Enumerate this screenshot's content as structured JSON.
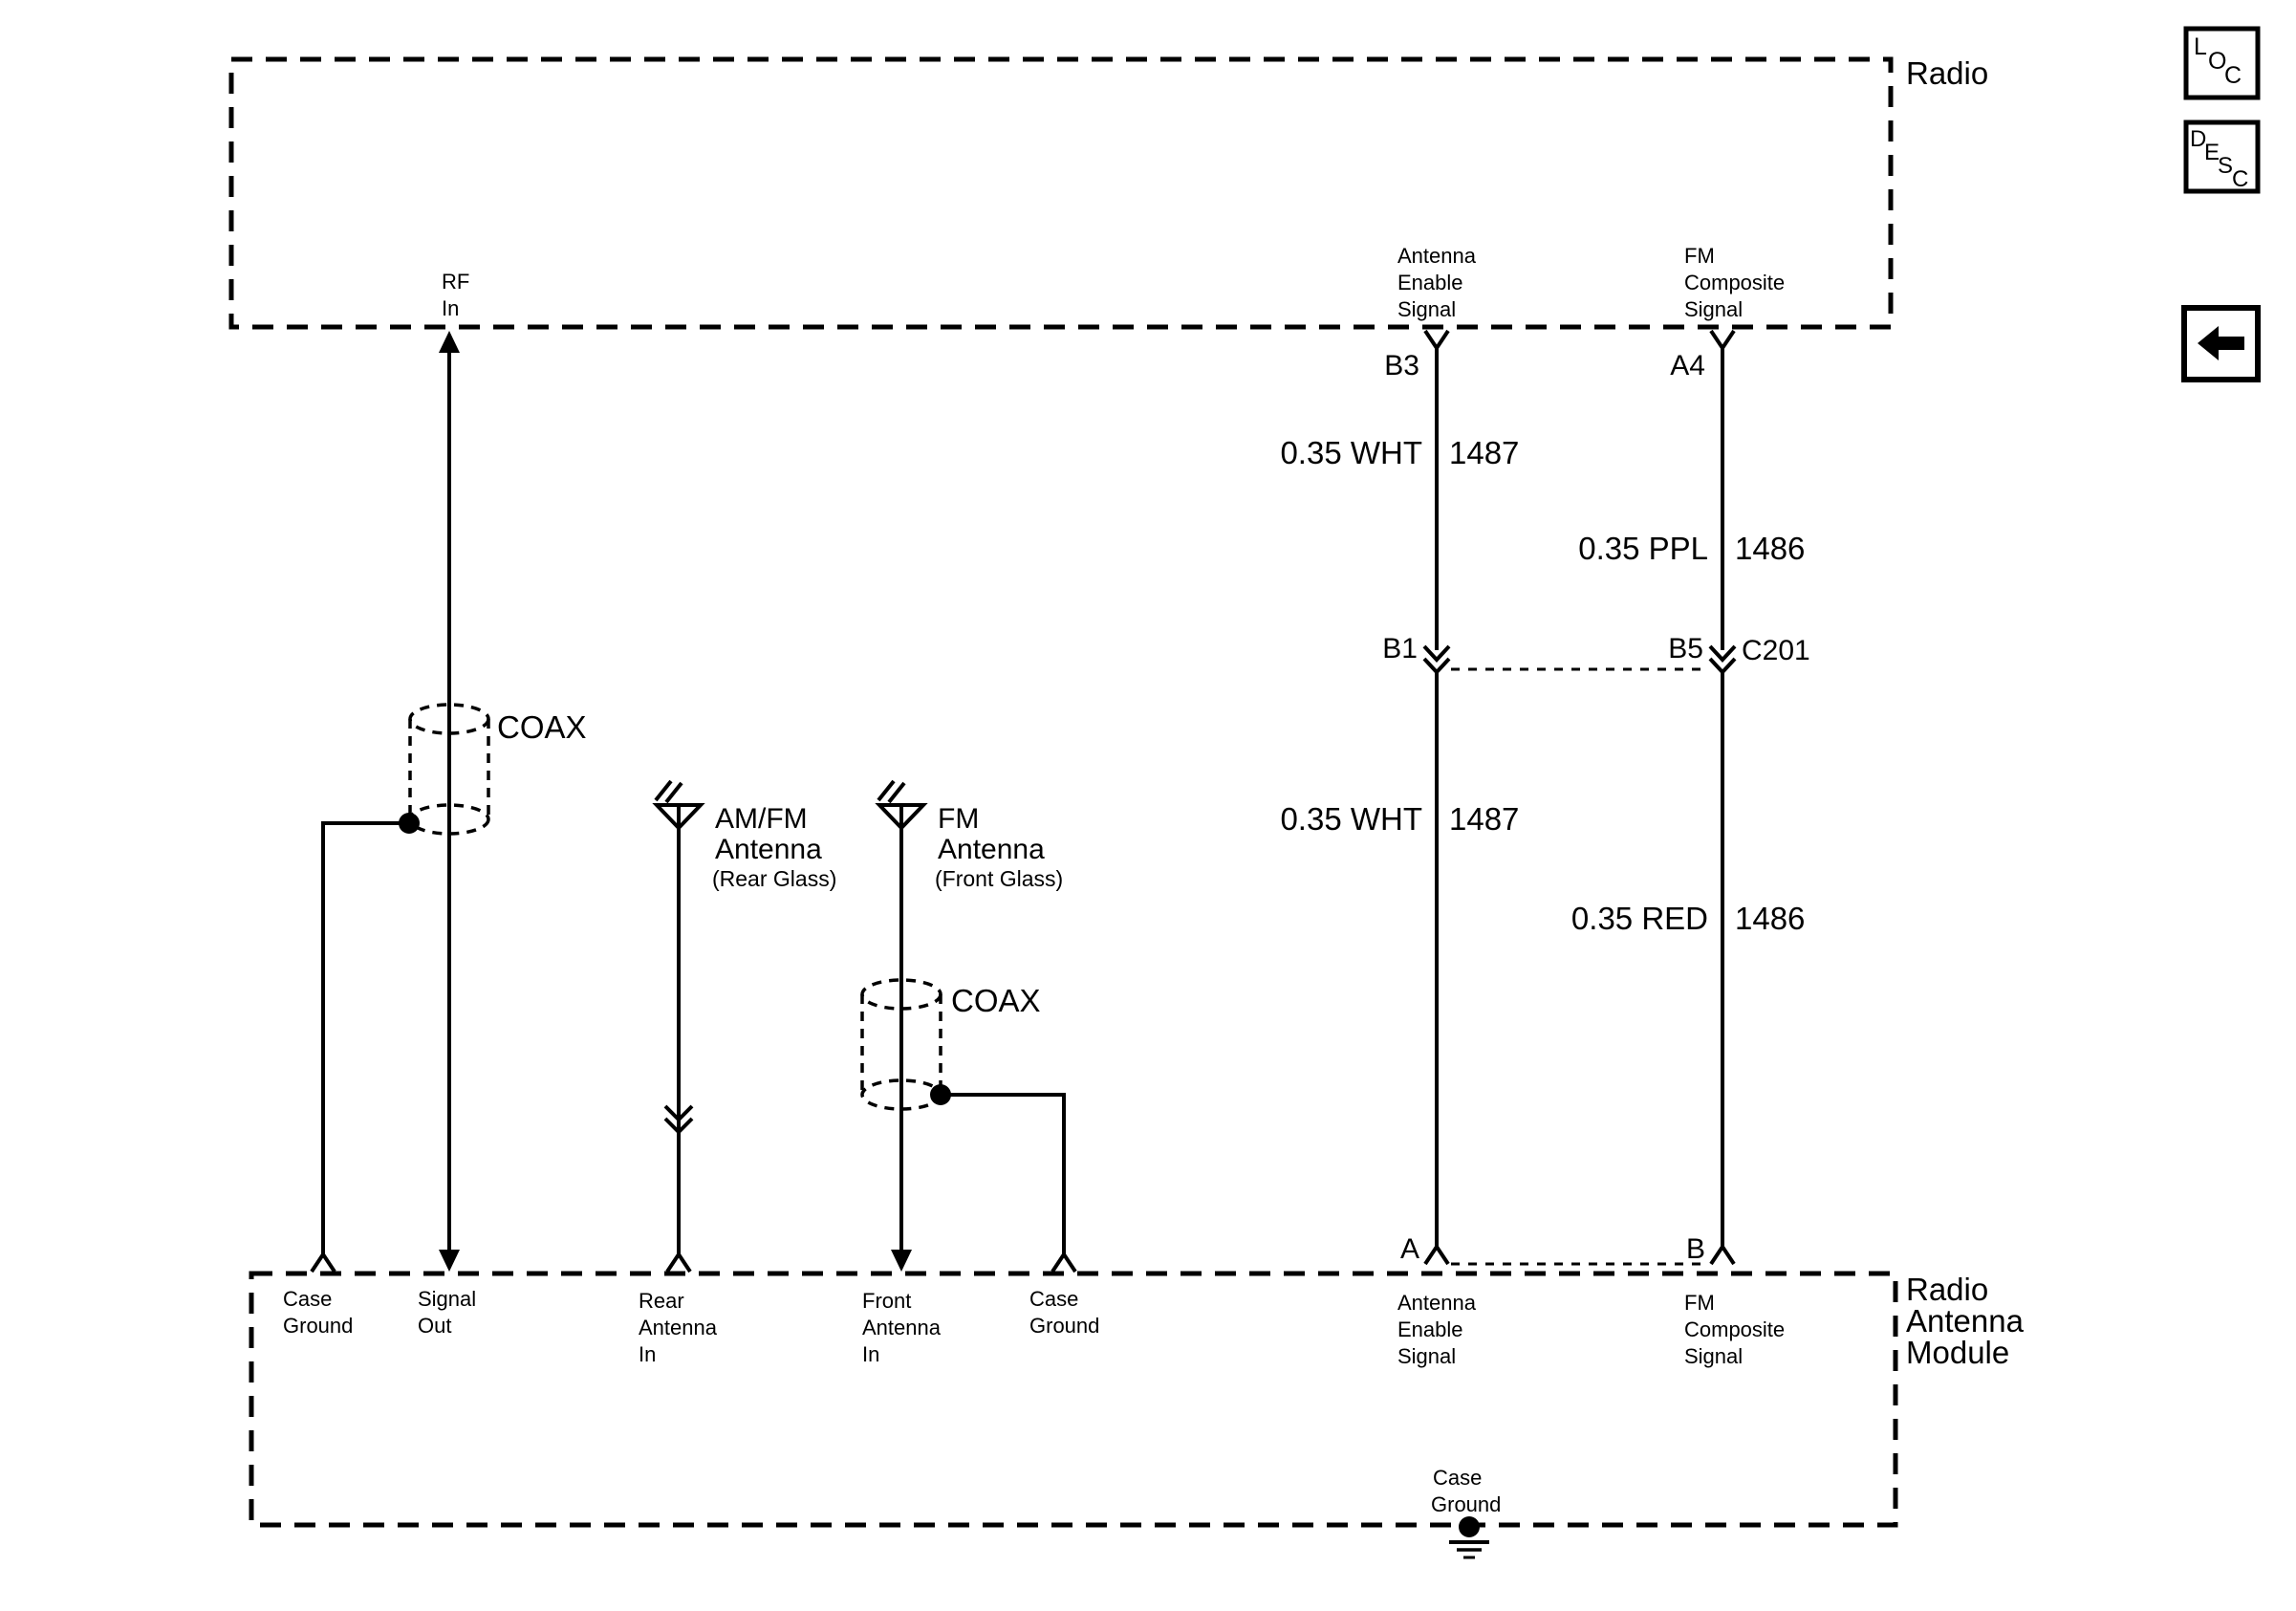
{
  "colors": {
    "line": "#000000",
    "background": "#ffffff"
  },
  "diagram": {
    "radio": {
      "label": "Radio",
      "rf_in": {
        "l1": "RF",
        "l2": "In"
      },
      "antenna_enable": {
        "l1": "Antenna",
        "l2": "Enable",
        "l3": "Signal",
        "pin": "B3"
      },
      "fm_composite": {
        "l1": "FM",
        "l2": "Composite",
        "l3": "Signal",
        "pin": "A4"
      }
    },
    "wires": {
      "enable_upper": {
        "spec": "0.35 WHT",
        "circuit": "1487"
      },
      "composite_upper": {
        "spec": "0.35 PPL",
        "circuit": "1486"
      },
      "enable_lower": {
        "spec": "0.35 WHT",
        "circuit": "1487"
      },
      "composite_lower": {
        "spec": "0.35 RED",
        "circuit": "1486"
      }
    },
    "connector_c201": {
      "label": "C201",
      "pin_left": "B1",
      "pin_right": "B5"
    },
    "coax_rf": {
      "label": "COAX"
    },
    "coax_front": {
      "label": "COAX"
    },
    "rear_antenna": {
      "l1": "AM/FM",
      "l2": "Antenna",
      "sub": "(Rear Glass)"
    },
    "front_antenna": {
      "l1": "FM",
      "l2": "Antenna",
      "sub": "(Front Glass)"
    },
    "module": {
      "label_l1": "Radio",
      "label_l2": "Antenna",
      "label_l3": "Module",
      "case_ground_left": {
        "l1": "Case",
        "l2": "Ground"
      },
      "signal_out": {
        "l1": "Signal",
        "l2": "Out"
      },
      "rear_in": {
        "l1": "Rear",
        "l2": "Antenna",
        "l3": "In"
      },
      "front_in": {
        "l1": "Front",
        "l2": "Antenna",
        "l3": "In"
      },
      "case_ground_mid": {
        "l1": "Case",
        "l2": "Ground"
      },
      "antenna_enable": {
        "l1": "Antenna",
        "l2": "Enable",
        "l3": "Signal",
        "pin": "A"
      },
      "fm_composite": {
        "l1": "FM",
        "l2": "Composite",
        "l3": "Signal",
        "pin": "B"
      },
      "case_ground_bottom": {
        "l1": "Case",
        "l2": "Ground"
      }
    }
  },
  "toolbar": {
    "loc": {
      "c1": "L",
      "c2": "O",
      "c3": "C"
    },
    "desc": {
      "c1": "D",
      "c2": "E",
      "c3": "S",
      "c4": "C"
    },
    "back_icon": "left-arrow"
  }
}
